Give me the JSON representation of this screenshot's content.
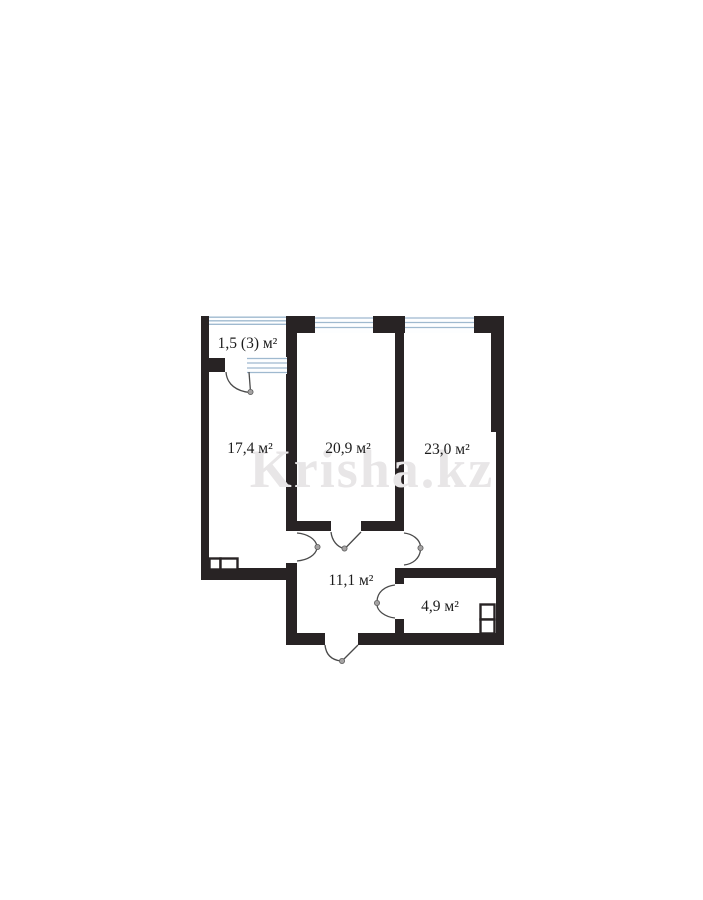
{
  "page": {
    "background_color": "#ffffff",
    "type": "apartment-floor-plan"
  },
  "floorplan": {
    "watermark": "Krisha.kz",
    "colors": {
      "wall": "#282324",
      "window_line": "#9fb9cf",
      "door_line": "#4a4a4a",
      "label_text": "#1c1c1c",
      "watermark_text": "#e8e6e7"
    },
    "rooms": [
      {
        "id": "balcony",
        "label": "1,5 (3) м²"
      },
      {
        "id": "room-17",
        "label": "17,4 м²"
      },
      {
        "id": "room-20",
        "label": "20,9 м²"
      },
      {
        "id": "room-23",
        "label": "23,0 м²"
      },
      {
        "id": "hallway",
        "label": "11,1 м²"
      },
      {
        "id": "bathroom",
        "label": "4,9 м²"
      }
    ]
  }
}
